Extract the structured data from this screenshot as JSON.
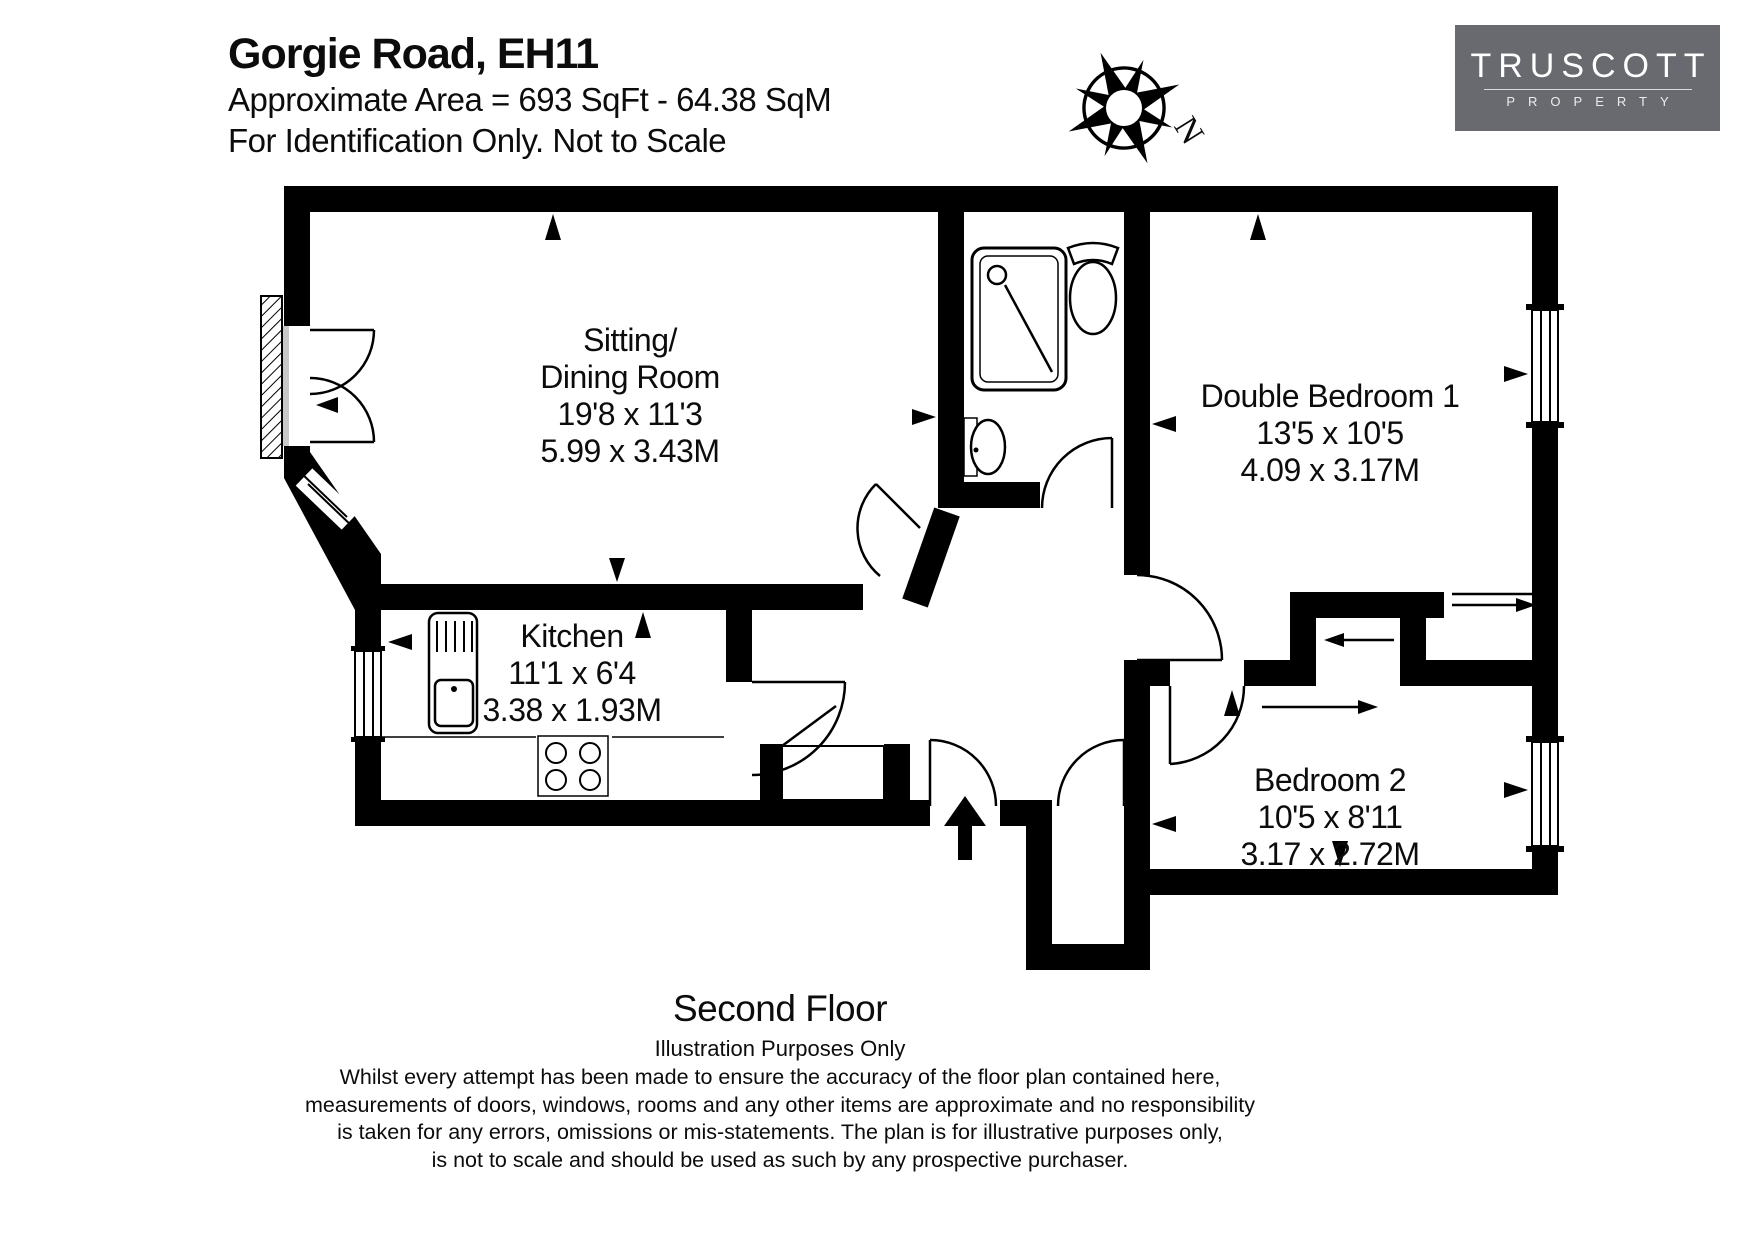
{
  "header": {
    "title": "Gorgie Road, EH11",
    "area_line": "Approximate Area = 693 SqFt - 64.38 SqM",
    "note_line": "For Identification Only. Not to Scale"
  },
  "logo": {
    "name": "TRUSCOTT",
    "subtitle": "PROPERTY"
  },
  "compass": {
    "north_label": "N"
  },
  "rooms": {
    "sitting": {
      "name_line1": "Sitting/",
      "name_line2": "Dining Room",
      "imperial": "19'8 x 11'3",
      "metric": "5.99 x 3.43M"
    },
    "kitchen": {
      "name": "Kitchen",
      "imperial": "11'1 x 6'4",
      "metric": "3.38 x 1.93M"
    },
    "bedroom1": {
      "name": "Double Bedroom 1",
      "imperial": "13'5 x 10'5",
      "metric": "4.09 x 3.17M"
    },
    "bedroom2": {
      "name": "Bedroom 2",
      "imperial": "10'5 x 8'11",
      "metric": "3.17 x 2.72M"
    }
  },
  "floor": {
    "label": "Second Floor"
  },
  "disclaimer": {
    "heading": "Illustration Purposes Only",
    "line1": "Whilst every attempt has been made to ensure the accuracy of the floor plan contained here,",
    "line2": "measurements of doors, windows, rooms and any other items are approximate and no responsibility",
    "line3": "is taken for any errors, omissions or mis-statements. The plan is for illustrative purposes only,",
    "line4": "is not to scale and should be used as such by any prospective purchaser."
  },
  "colors": {
    "wall": "#000000",
    "logo_bg": "#696a6f",
    "background": "#ffffff"
  }
}
